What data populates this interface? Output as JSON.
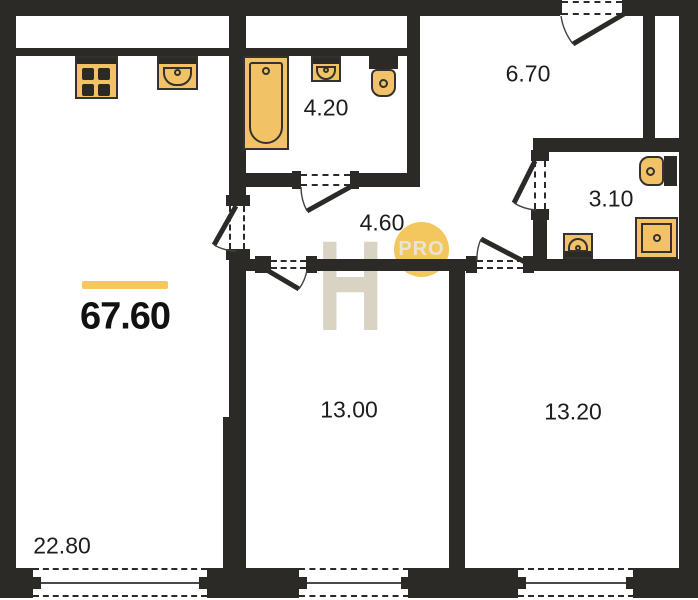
{
  "title": "Apartment floor plan",
  "total": {
    "area": "67.60",
    "accent_color": "#f6c75f"
  },
  "rooms": [
    {
      "name": "living-room",
      "area": "22.80"
    },
    {
      "name": "bathroom",
      "area": "4.20"
    },
    {
      "name": "hallway",
      "area": "4.60"
    },
    {
      "name": "entry-hall",
      "area": "6.70"
    },
    {
      "name": "wc",
      "area": "3.10"
    },
    {
      "name": "room-1",
      "area": "13.00"
    },
    {
      "name": "room-2",
      "area": "13.20"
    }
  ],
  "watermark": {
    "letter": "H",
    "badge": "PRO",
    "badge_color": "#f3c75e",
    "letter_color": "#d9d3c4"
  },
  "colors": {
    "wall": "#2b2a27",
    "fixture_fill": "#f2c366",
    "fixture_stroke": "#33322e",
    "background": "#ffffff",
    "label_text": "#1d1d1b"
  },
  "fixtures": [
    "stove-icon",
    "kitchen-sink-icon",
    "bathtub-icon",
    "washbasin-icon",
    "toilet-icon",
    "toilet-icon",
    "washbasin-icon",
    "shower-tray-icon"
  ]
}
